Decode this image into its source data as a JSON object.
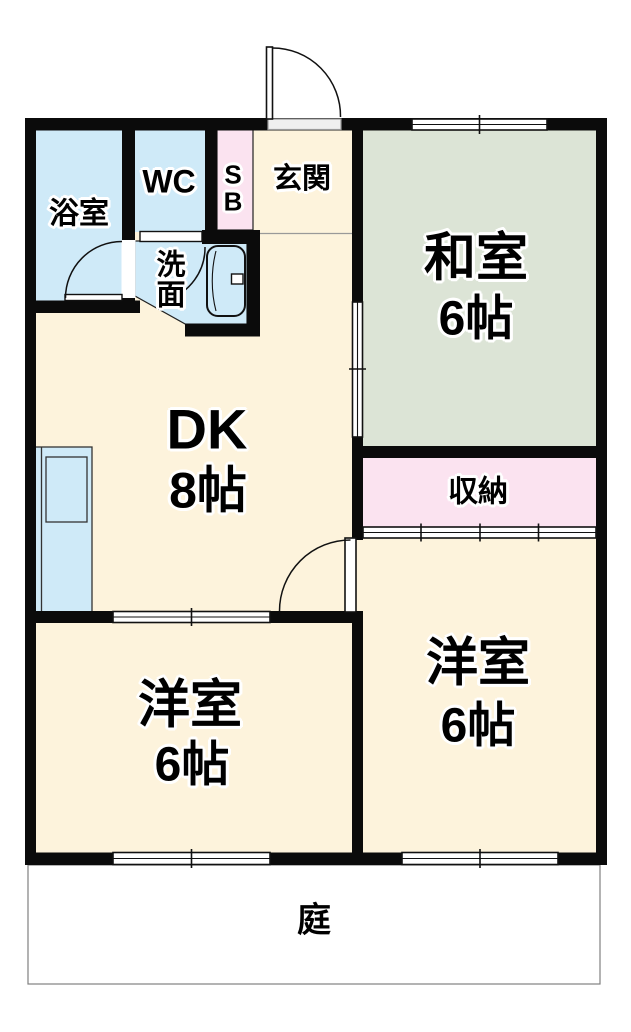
{
  "title": "2DK floor plan",
  "colors": {
    "wall": "#0b0b0b",
    "room_cream": "#fdf3dc",
    "room_blue": "#cfeaf8",
    "room_pink": "#fbe3f0",
    "room_green": "#dce4d6"
  },
  "rooms": {
    "bath": {
      "label": "浴室"
    },
    "wc": {
      "label": "WC"
    },
    "shoe_box": {
      "line1": "S",
      "line2": "B"
    },
    "entrance": {
      "label": "玄関"
    },
    "washroom": {
      "line1": "洗",
      "line2": "面"
    },
    "japanese_room": {
      "name": "和室",
      "size": "6帖"
    },
    "dining_kitchen": {
      "name": "DK",
      "size": "8帖"
    },
    "closet": {
      "label": "収納"
    },
    "western_room_left": {
      "name": "洋室",
      "size": "6帖"
    },
    "western_room_right": {
      "name": "洋室",
      "size": "6帖"
    },
    "garden": {
      "label": "庭"
    }
  }
}
